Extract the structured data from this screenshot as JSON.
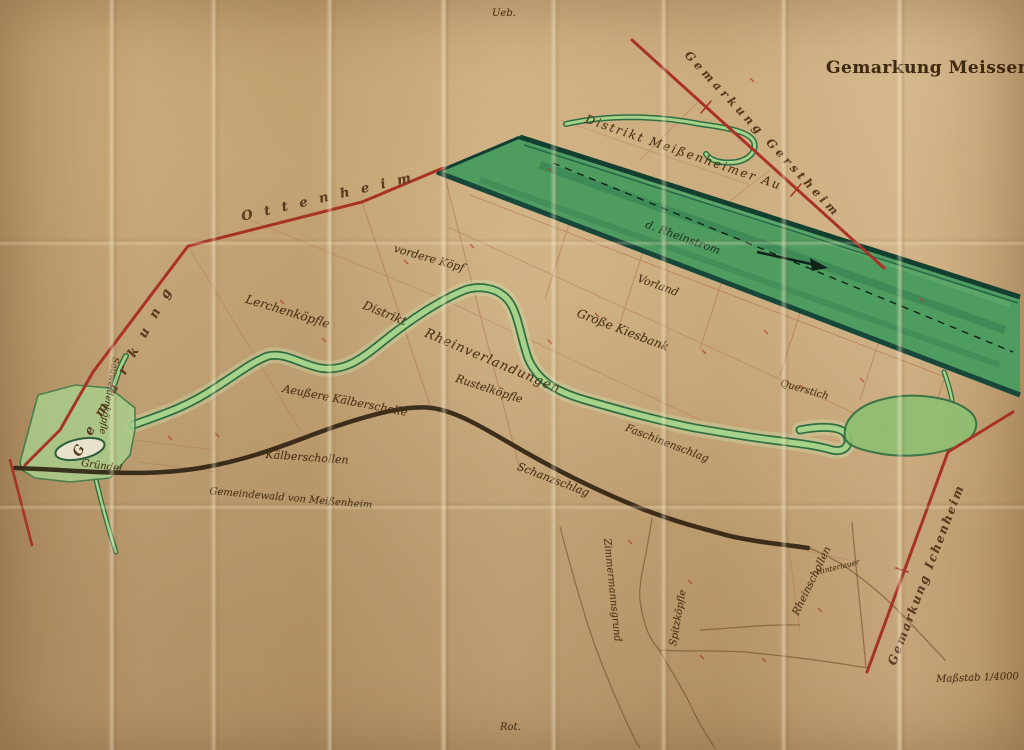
{
  "map": {
    "title": "Gemarkung Meissenheim",
    "scale_label": "Maßstab 1/4000",
    "sheet_note_top": "Ueb.",
    "sheet_note_bottom": "Rot.",
    "neighbor_boundaries": {
      "ottenheim_prefix": "Gemarkung",
      "ottenheim_name": "Ottenheim",
      "gerstheim": "Gemarkung Gerstheim",
      "ichenheim": "Gemarkung Ichenheim"
    },
    "districts": {
      "au": "Distrikt Meißenheimer Au",
      "rheinstrom": "d. Rheinstrom",
      "vorland": "Vorland",
      "vordere_koepf": "vordere Köpf",
      "lerchenkoepfle": "Lerchenköpfle",
      "distrikt": "Distrikt",
      "rheinverlandungen": "Rheinverlandungen",
      "grosse_kiesbank": "Große Kiesbank",
      "rustelkoepfle": "Rustelköpfle",
      "querstich": "Querstich",
      "faschinenschlag": "Faschinenschlag",
      "aeussere_kaelberscholle": "Aeußere Kälberscholle",
      "kaelberschollen": "Kälberschollen",
      "gemeindewald": "Gemeindewald von Meißenheim",
      "schanzschlag": "Schanzschlag",
      "zimmermannsgrund": "Zimmermannsgrund",
      "spitzkoepfle": "Spitzköpfle",
      "rheinschollen": "Rheinschollen",
      "hinterlauer": "Hinterlauer",
      "sauweidenkoepfle": "Sauweidenköpfle",
      "gruendel": "Gründel"
    },
    "colors": {
      "paper": "#c5a373",
      "boundary_red": "#a83226",
      "rhine_green": "#4f9c60",
      "channel_green": "#8cbf72",
      "edge_green": "#16473a",
      "ink": "#42301a"
    }
  }
}
